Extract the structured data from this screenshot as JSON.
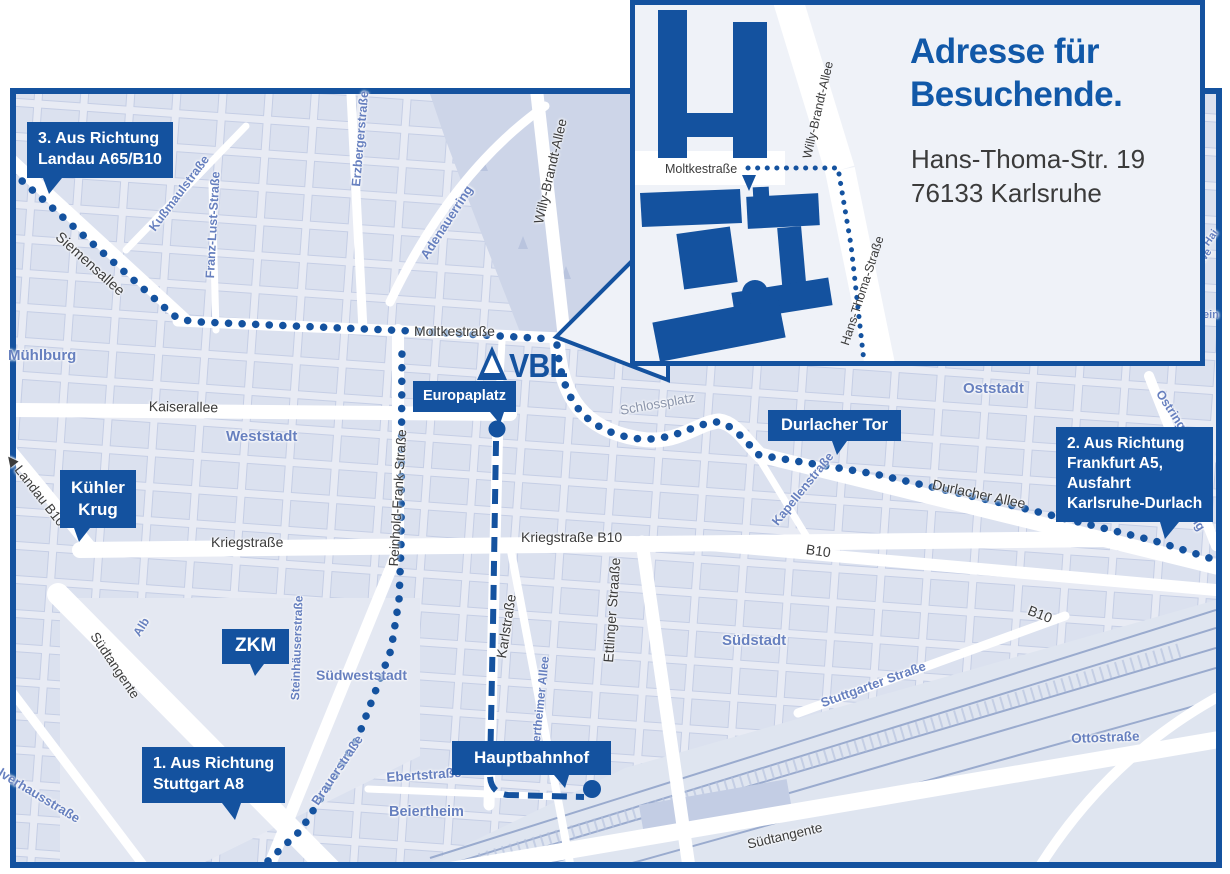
{
  "colors": {
    "accent_blue": "#14529f",
    "title_blue": "#1158a8",
    "district_label_blue": "#6780bf",
    "street_text": "#3b3b3b",
    "map_background": "#e8ebf4"
  },
  "logo": {
    "text": "VBL"
  },
  "icons": {
    "direction_arrow": "◀",
    "tree_icon": "▲"
  },
  "inset": {
    "title": "Adresse für\nBesuchende.",
    "address": "Hans-Thoma-Str. 19\n76133 Karlsruhe",
    "labels": {
      "moltkestrasse": "Moltkestraße",
      "willy_brandt_allee": "Willy-Brandt-Allee",
      "hans_thoma_strasse": "Hans-Thoma-Straße"
    }
  },
  "callouts": {
    "landau": "3. Aus Richtung\nLandau A65/B10",
    "kuehler_krug": "Kühler\nKrug",
    "zkm": "ZKM",
    "stuttgart": "1. Aus Richtung\nStuttgart A8",
    "europaplatz": "Europaplatz",
    "durlacher_tor": "Durlacher Tor",
    "frankfurt": "2. Aus Richtung\nFrankfurt A5,\nAusfahrt\nKarlsruhe-Durlach",
    "hauptbahnhof": "Hauptbahnhof"
  },
  "labels": {
    "siemensallee": "Siemensallee",
    "kussmaulstrasse": "Kußmaulstraße",
    "franz_lust_strasse": "Franz-Lust-Straße",
    "erzbergerstrasse": "Erzbergerstraße",
    "adenauerring": "Adenauerring",
    "willy_brandt_allee": "Willy-Brandt-Allee",
    "moltkestrasse": "Moltkestraße",
    "muehlburg": "Mühlburg",
    "kaiserallee": "Kaiserallee",
    "weststadt": "Weststadt",
    "landau_b10": "Landau B10",
    "reinhold_frank_strasse": "Reinhold-Frank-Straße",
    "kriegstrasse": "Kriegstraße",
    "kriegstrasse_b10": "Kriegstraße B10",
    "schlossplatz": "Schlossplatz",
    "oststadt": "Oststadt",
    "durlacher_allee": "Durlacher Allee",
    "kapellenstrasse": "Kapellenstraße",
    "ostring_1": "Ostring",
    "ostring_2": "Ostring",
    "b10_mid": "B10",
    "b10_south": "B10",
    "karlstrasse": "Karlstraße",
    "ettlinger_strasse": "Ettlinger Straaße",
    "beiertheimer_allee": "Beiertheimer Allee",
    "suedstadt": "Südstadt",
    "stuttgarter_strasse": "Stuttgarter Straße",
    "steinhaeuserstrasse": "Steinhäuserstraße",
    "suedweststadt": "Südweststadt",
    "alb": "Alb",
    "suedtangente_west": "Südtangente",
    "brauerstrasse": "Brauerstraße",
    "ebertstrasse": "Ebertstraße",
    "beiertheim": "Beiertheim",
    "pulverhausstrasse": "lverhausstraße",
    "suedtangente_sued": "Südtangente",
    "ottostrasse": "Ottostraße",
    "edge_partial_hai": "Hai",
    "edge_partial_we": "we",
    "edge_partial_ein": "ein"
  }
}
